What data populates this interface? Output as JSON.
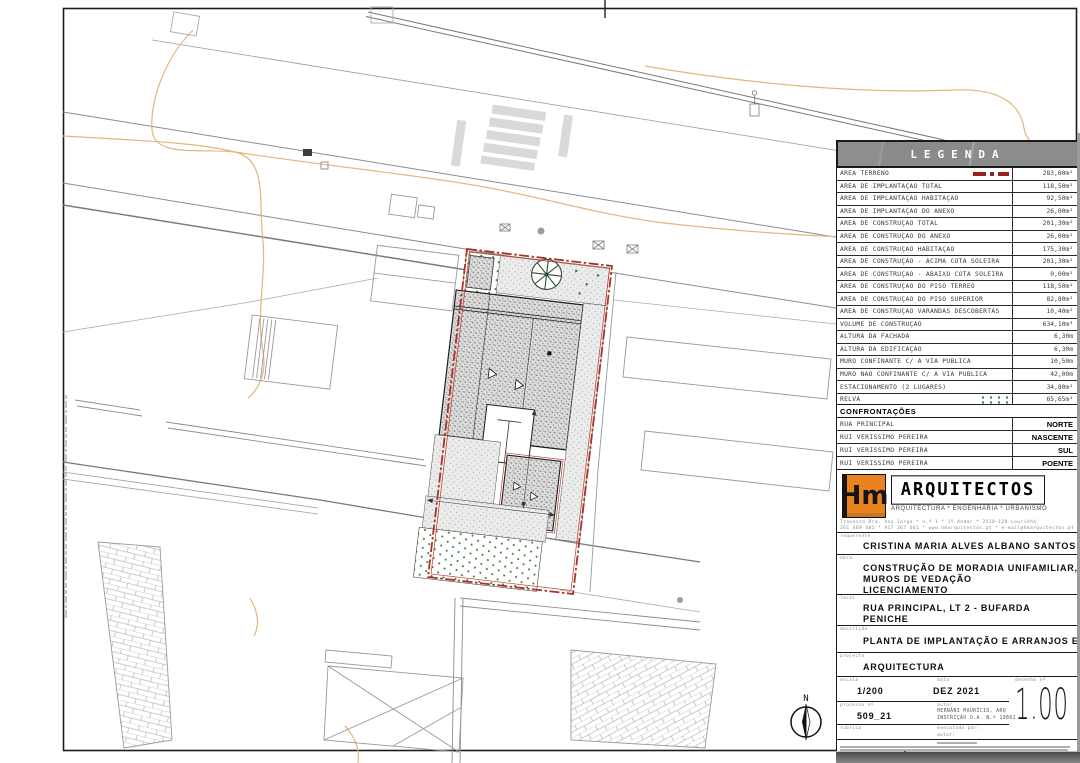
{
  "legend": {
    "title": "LEGENDA",
    "rows": [
      {
        "label": "ÁREA TERRENO",
        "value": "283,00m²",
        "symbol": "boundary"
      },
      {
        "label": "ÁREA DE IMPLANTAÇÃO TOTAL",
        "value": "118,50m²",
        "symbol": null
      },
      {
        "label": "ÁREA DE IMPLANTAÇÃO HABITAÇÃO",
        "value": "92,50m²",
        "symbol": null
      },
      {
        "label": "ÁREA DE IMPLANTAÇÃO DO ANEXO",
        "value": "26,00m²",
        "symbol": null
      },
      {
        "label": "ÁREA DE CONSTRUÇÃO TOTAL",
        "value": "201,30m²",
        "symbol": null
      },
      {
        "label": "ÁREA DE CONSTRUÇÃO DO ANEXO",
        "value": "26,00m²",
        "symbol": null
      },
      {
        "label": "ÁREA DE CONSTRUÇÃO HABITAÇÃO",
        "value": "175,30m²",
        "symbol": null
      },
      {
        "label": "ÁREA DE CONSTRUÇÃO - ACIMA COTA SOLEIRA",
        "value": "201,30m²",
        "symbol": null
      },
      {
        "label": "ÁREA DE CONSTRUÇÃO - ABAIXO COTA SOLEIRA",
        "value": "0,00m²",
        "symbol": null
      },
      {
        "label": "ÁREA DE CONSTRUÇÃO DO PISO TÉRREO",
        "value": "118,50m²",
        "symbol": null
      },
      {
        "label": "ÁREA DE CONSTRUÇÃO DO PISO SUPERIOR",
        "value": "82,80m²",
        "symbol": null
      },
      {
        "label": "ÁREA DE CONSTRUÇÃO VARANDAS DESCOBERTAS",
        "value": "10,40m²",
        "symbol": null
      },
      {
        "label": "VOLUME DE CONSTRUÇÃO",
        "value": "634,10m³",
        "symbol": null
      },
      {
        "label": "ALTURA DA FACHADA",
        "value": "6,30m",
        "symbol": null
      },
      {
        "label": "ALTURA DA EDIFICAÇÃO",
        "value": "6,30m",
        "symbol": null
      },
      {
        "label": "MURO CONFINANTE C/ A VIA PÚBLICA",
        "value": "10,50m",
        "symbol": null
      },
      {
        "label": "MURO NÃO CONFINANTE C/ A VIA PÚBLICA",
        "value": "42,00m",
        "symbol": null
      },
      {
        "label": "ESTACIONAMENTO (2 LUGARES)",
        "value": "34,80m²",
        "symbol": null
      },
      {
        "label": "RELVA",
        "value": "65,65m²",
        "symbol": "grass"
      },
      {
        "label": "PAVÊ",
        "value": "96,60m²",
        "symbol": "pave"
      }
    ],
    "confrontacoes": {
      "header": "CONFRONTAÇÕES",
      "rows": [
        {
          "label": "RUA PRINCIPAL",
          "value": "NORTE"
        },
        {
          "label": "RUI VERISSIMO PEREIRA",
          "value": "NASCENTE"
        },
        {
          "label": "RUI VERISSIMO PEREIRA",
          "value": "SUL"
        },
        {
          "label": "RUI VERISSIMO PEREIRA",
          "value": "POENTE"
        }
      ]
    }
  },
  "title_block": {
    "logo": {
      "monogram": "Hm",
      "name": "ARQUITECTOS",
      "tagline": "ARQUITECTURA * ENGENHARIA * URBANISMO",
      "address_line1": "Travessa Dra. Ana Jorge * n.º 1 * 1º Andar * 2510-128 Lourinhã",
      "address_line2": "261 469 481 * 917 367 661 * www.hmarquitectos.pt * e-mail@hmarquitectos.pt"
    },
    "labels": {
      "requerente": "requerente",
      "obra": "obra",
      "local": "local",
      "descricao": "descrição",
      "projecto": "projecto",
      "escala": "escala",
      "data": "data",
      "desenho": "desenho nº",
      "processo": "processo nº",
      "autor": "autor",
      "rubrica": "rubrica",
      "executado": "executado por:",
      "autor2": "autor:"
    },
    "requerente": "CRISTINA MARIA ALVES ALBANO SANTOS",
    "obra_lines": [
      "CONSTRUÇÃO DE MORADIA UNIFAMILIAR, ANEXO E",
      "MUROS DE VEDAÇÃO",
      "LICENCIAMENTO"
    ],
    "local_lines": [
      "RUA PRINCIPAL, LT 2 - BUFARDA",
      "PENICHE"
    ],
    "descricao": "PLANTA DE IMPLANTAÇÃO E ARRANJOS EXTERIORES",
    "projecto": "ARQUITECTURA",
    "escala": "1/200",
    "data": "DEZ 2021",
    "desenho_num": "1.00",
    "processo": "509_21",
    "autor_line1": "HERNÂNI MAURÍCIO, ARQ",
    "autor_line2": "INSCRIÇÃO O.A. N.º 19862"
  },
  "north_label": "N"
}
